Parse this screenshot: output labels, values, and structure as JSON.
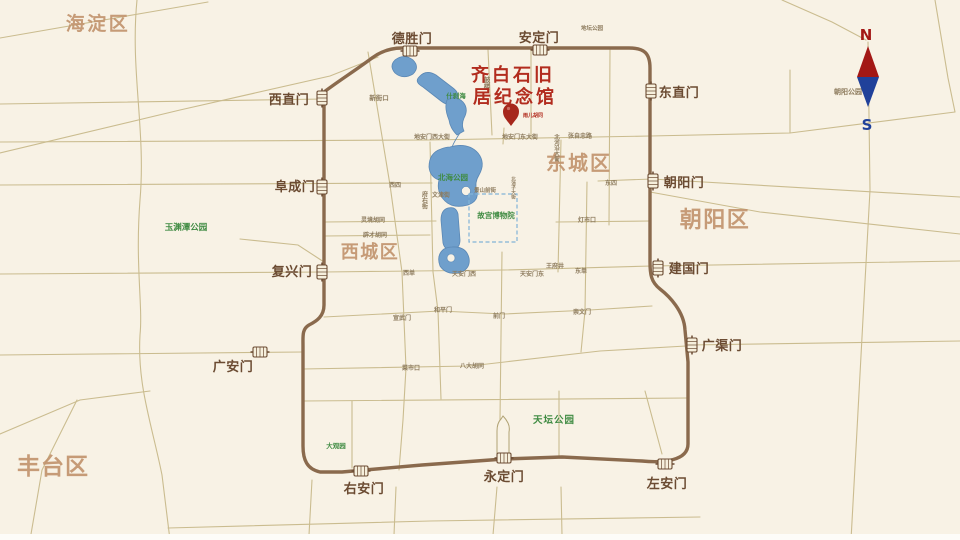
{
  "title": {
    "line1": "齐白石旧",
    "line2": "居纪念馆"
  },
  "pin": {
    "label": "雨儿胡同"
  },
  "compass": {
    "north": "N",
    "south": "S"
  },
  "districts": {
    "haidian": "海淀区",
    "dongcheng": "东城区",
    "xicheng": "西城区",
    "chaoyang": "朝阳区",
    "fengtai": "丰台区"
  },
  "gates": {
    "deshengmen": "德胜门",
    "andingmen": "安定门",
    "xizhimen": "西直门",
    "dongzhimen": "东直门",
    "fuchengmen": "阜成门",
    "chaoyangmen": "朝阳门",
    "fuxingmen": "复兴门",
    "jianguomen": "建国门",
    "guanganmen": "广安门",
    "guangqumen": "广渠门",
    "youanmen": "右安门",
    "yongdingmen": "永定门",
    "zuoanmen": "左安门"
  },
  "parks": {
    "shichahai": "什刹海",
    "beihai": "北海公园",
    "gugong": "故宫博物院",
    "yuyuantan": "玉渊潭公园",
    "tiantan": "天坛公园",
    "daguanyuan": "大观园",
    "chaoyangpark": "朝阳公园",
    "ditan": "地坛公园"
  },
  "streets": {
    "xinjiekou": "新街口",
    "xisi": "西四",
    "gulou": "鼓楼",
    "lingjing": "灵境胡同",
    "picai": "辟才胡同",
    "wenjin": "文津街",
    "fuyou": "府右街",
    "jingshanqian": "景山前街",
    "beichizi": "北池子大街",
    "dianmen_west": "地安门西大街",
    "dianmen_east": "地安门东大街",
    "zhangzizhong": "张自忠路",
    "beiheyan": "北河沿大街",
    "dongsi": "东四",
    "dengshikou": "灯市口",
    "wangfujing": "王府井",
    "xidan": "西单",
    "tiananmen_west": "天安门西",
    "tiananmen_east": "天安门东",
    "dongdan": "东单",
    "xuanwumen": "宣武门",
    "hepingmen": "和平门",
    "qianmen": "前门",
    "chongwenmen": "崇文门",
    "caishikou": "菜市口",
    "badahutong": "八大胡同"
  },
  "colors": {
    "bg": "#f8f2e5",
    "road": "#c3b381",
    "ring": "#8a6a4d",
    "lake": "#6f9fcc",
    "lake_stroke": "#5b88b5",
    "moat": "#82b4d8",
    "district": "#c2946e",
    "gate": "#6b4b32",
    "title_red": "#b22c1e",
    "pin_red": "#a6271c",
    "park_green": "#3f8b42",
    "minor": "#8d7b5d",
    "compass_red": "#a31815",
    "compass_blue": "#20419a",
    "tower": "#b0a273"
  }
}
